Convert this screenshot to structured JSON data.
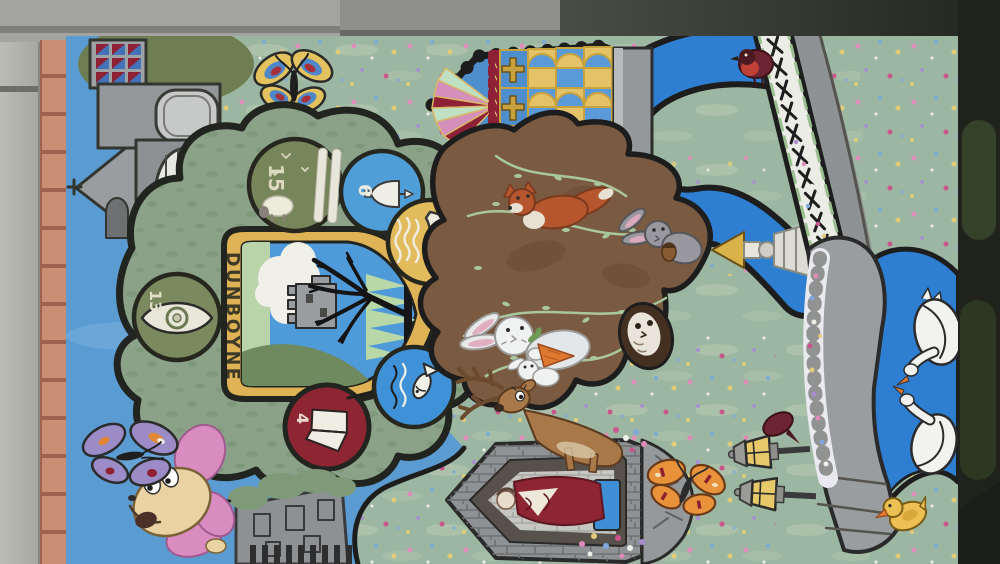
{
  "mural": {
    "crest_title": "DUNBOYNE",
    "badges": {
      "sheep": {
        "number": "15"
      },
      "bell": {
        "number": "6"
      },
      "boat": {
        "number": "2"
      },
      "ball": {
        "number": "13"
      },
      "book": {
        "number": "4"
      }
    },
    "colors": {
      "sky": "#5a9cd2",
      "meadow": "#9cb7a1",
      "river": "#2e7fd2",
      "crest_green": "#8ba289",
      "gold": "#dfb255",
      "maroon": "#8e2533",
      "brick": "#c58a70"
    }
  }
}
